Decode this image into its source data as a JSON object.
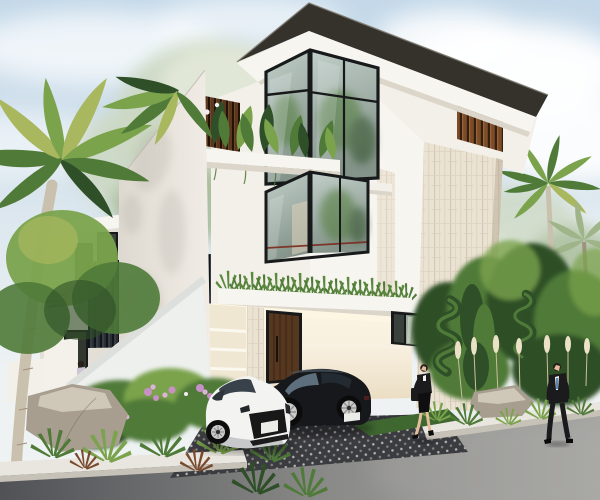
{
  "meta": {
    "type": "architectural-exterior-rendering",
    "subject": "modern three-story white villa with tropical landscaping, two sports cars and two pedestrians",
    "time_of_day": "day"
  },
  "palette": {
    "sky_top": "#c3d8e9",
    "sky_low": "#eef2f3",
    "cloud": "#ffffff",
    "pale_tree": "#ccd8c3",
    "pale_tree_lt": "#e3e9d8",
    "pale_tree_dk": "#a3b894",
    "roof_dark": "#35322c",
    "roof_edge": "#7b786e",
    "fascia": "#f7f5f0",
    "fascia_shadow": "#dcd6ca",
    "wall_white": "#f3f0ea",
    "wall_shadow": "#e4dfd6",
    "wall_warm": "#f8f0e0",
    "wall_warm_deep": "#e9dcc1",
    "glow": "#fdf6e2",
    "glass_top": "#c2cfca",
    "glass_bot": "#84948a",
    "glass_streak": "#eef3f4",
    "frame": "#17191b",
    "wood": "#7c4b28",
    "wood_hl": "#9a6338",
    "wood_gap": "#32200f",
    "walnut": "#5a3820",
    "walnut_gap": "#231307",
    "screen_dark": "#2a3036",
    "screen_gap": "#12161b",
    "screen_hl": "#454d55",
    "stone": "#eae2d2",
    "stone_line": "#d6cab4",
    "leaf_dark": "#2f4f28",
    "leaf_mid": "#4f7a38",
    "leaf_light": "#7aa34c",
    "leaf_yellow": "#a9b85e",
    "leaf_pale": "#9fb489",
    "grass": "#5b8a3e",
    "lawn": "#3f6830",
    "trunk": "#c9c0ad",
    "trunk_dark": "#a0927c",
    "flower_pink": "#c791c6",
    "flower_lilac": "#ddb4d9",
    "flower_white": "#f3edf2",
    "pampas": "#eae1c6",
    "rock_light": "#cfc7b8",
    "rock_mid": "#a89e8f",
    "rock_dark": "#7d7567",
    "curb": "#e9e6df",
    "curb_shadow": "#c6c2b8",
    "paver": "#3b3c40",
    "paver_dot": "#b7b5b0",
    "paver_dot2": "#84827e",
    "road_dark": "#505256",
    "road_light": "#a5a5a2",
    "door_wood": "#55381f",
    "door_wood_dark": "#39240f",
    "rail_red": "#7c2a1e",
    "car_white": "#f3f3f1",
    "car_white_shade": "#c6c8c9",
    "car_black": "#16181b",
    "car_black_hl": "#4a545e",
    "grille": "#181818",
    "plate": "#ebebe8",
    "wheel_rim": "#cbcbca",
    "wheel_dark": "#222222",
    "windshield": "#5d6e7c",
    "skin": "#e5bd9d",
    "hair": "#261f1a",
    "suit": "#1b1b1d",
    "shirt": "#f0f0ee",
    "tie": "#3a6ea8"
  },
  "scene": {
    "building": {
      "floors": 3,
      "features": [
        "dark flat overhang roof",
        "corner glass curtain windows with black frames",
        "vertical wood slat accents",
        "travertine stone tower",
        "planted balconies",
        "dark louvred screen wall",
        "warm lit entry with wood door",
        "white fin wall"
      ]
    },
    "vehicles": [
      {
        "name": "white-sports-coupe",
        "color": "white"
      },
      {
        "name": "black-sports-coupe",
        "color": "black"
      }
    ],
    "people": [
      {
        "name": "woman-walking",
        "outfit": "black blazer and skirt, handbag"
      },
      {
        "name": "man-walking",
        "outfit": "black suit, white shirt, blue tie"
      },
      {
        "name": "small-figure-at-side-entrance",
        "outfit": "light top, dark trousers"
      }
    ],
    "landscape": [
      "palm trees",
      "pale flowering tree",
      "spiral topiaries",
      "pampas grass",
      "boulders",
      "pink flowering shrubs",
      "agave plants",
      "lawn strips"
    ],
    "ground": [
      "diamond-stud paver driveway",
      "asphalt road",
      "white stone curbs"
    ]
  }
}
